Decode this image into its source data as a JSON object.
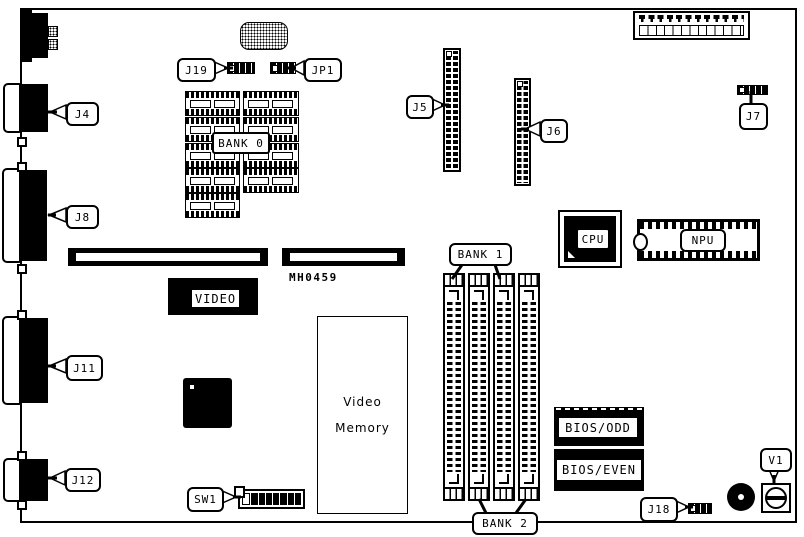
{
  "diagram": {
    "type": "motherboard-component-layout",
    "callouts": {
      "j19": "J19",
      "jp1": "JP1",
      "j4": "J4",
      "j5": "J5",
      "j6": "J6",
      "j7": "J7",
      "j8": "J8",
      "j11": "J11",
      "j12": "J12",
      "j18": "J18",
      "sw1": "SW1",
      "v1": "V1",
      "bank0": "BANK 0",
      "bank1": "BANK 1",
      "bank2": "BANK 2",
      "cpu": "CPU",
      "npu": "NPU",
      "video": "VIDEO",
      "bios_odd": "BIOS/ODD",
      "bios_even": "BIOS/EVEN"
    },
    "labels": {
      "board_id": "MH0459",
      "video_memory_line1": "Video",
      "video_memory_line2": "Memory"
    },
    "colors": {
      "ink": "#000000",
      "background": "#ffffff"
    }
  }
}
